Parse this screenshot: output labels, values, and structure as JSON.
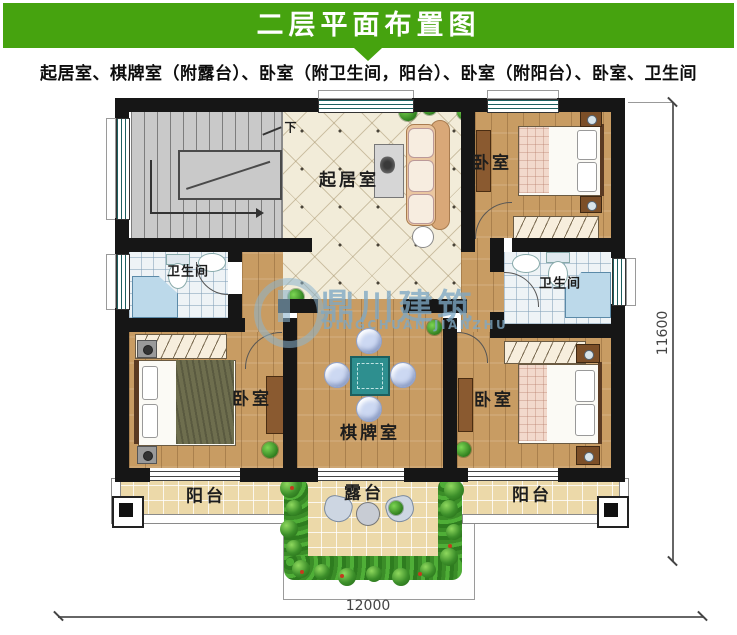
{
  "header": {
    "title": "二层平面布置图"
  },
  "subtitle": "起居室、棋牌室（附露台）、卧室（附卫生间，阳台）、卧室（附阳台）、卧室、卫生间",
  "watermark": {
    "name": "鼎川建筑",
    "latin": "DINGCHUAN JIANZHU"
  },
  "plan": {
    "rooms": {
      "living": "起居室",
      "bedroom_top_right": "卧室",
      "bedroom_bottom_left": "卧室",
      "bedroom_bottom_right": "卧室",
      "bath_left": "卫生间",
      "bath_right": "卫生间",
      "chess": "棋牌室",
      "balcony_left": "阳台",
      "balcony_right": "阳台",
      "terrace": "露台",
      "stairs_down": "下"
    },
    "dimensions": {
      "width_mm": "12000",
      "height_mm": "11600"
    }
  },
  "colors": {
    "accent_green": "#46a30f",
    "wall": "#161616",
    "wood_floor": "#c89c63",
    "tile_cream": "#f2ecd9",
    "bath_tile": "#eef3f6",
    "balcony_tile": "#ecd9a9",
    "watermark_blue": "#7da8c4",
    "mahjong_teal": "#2e8f8f"
  }
}
